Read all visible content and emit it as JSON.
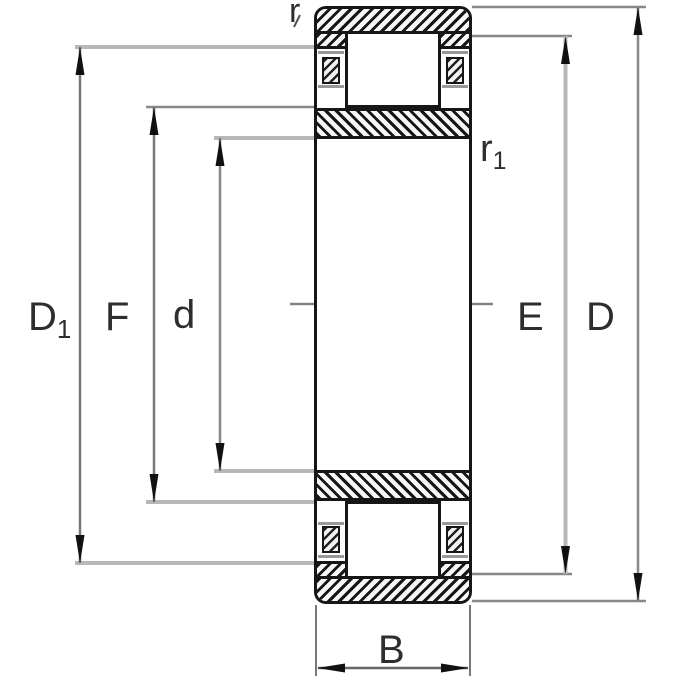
{
  "figure": {
    "labels": {
      "r": "r",
      "r1": {
        "main": "r",
        "sub": "1"
      },
      "D1": {
        "main": "D",
        "sub": "1"
      },
      "F": "F",
      "d": "d",
      "E": "E",
      "D": "D",
      "B": "B"
    },
    "colors": {
      "line_black": "#161616",
      "dim_gray": "#888888",
      "dim_light_gray": "#b8b8b8",
      "cage_gray": "#989898",
      "text": "#2e2e2e",
      "background": "#ffffff"
    }
  }
}
